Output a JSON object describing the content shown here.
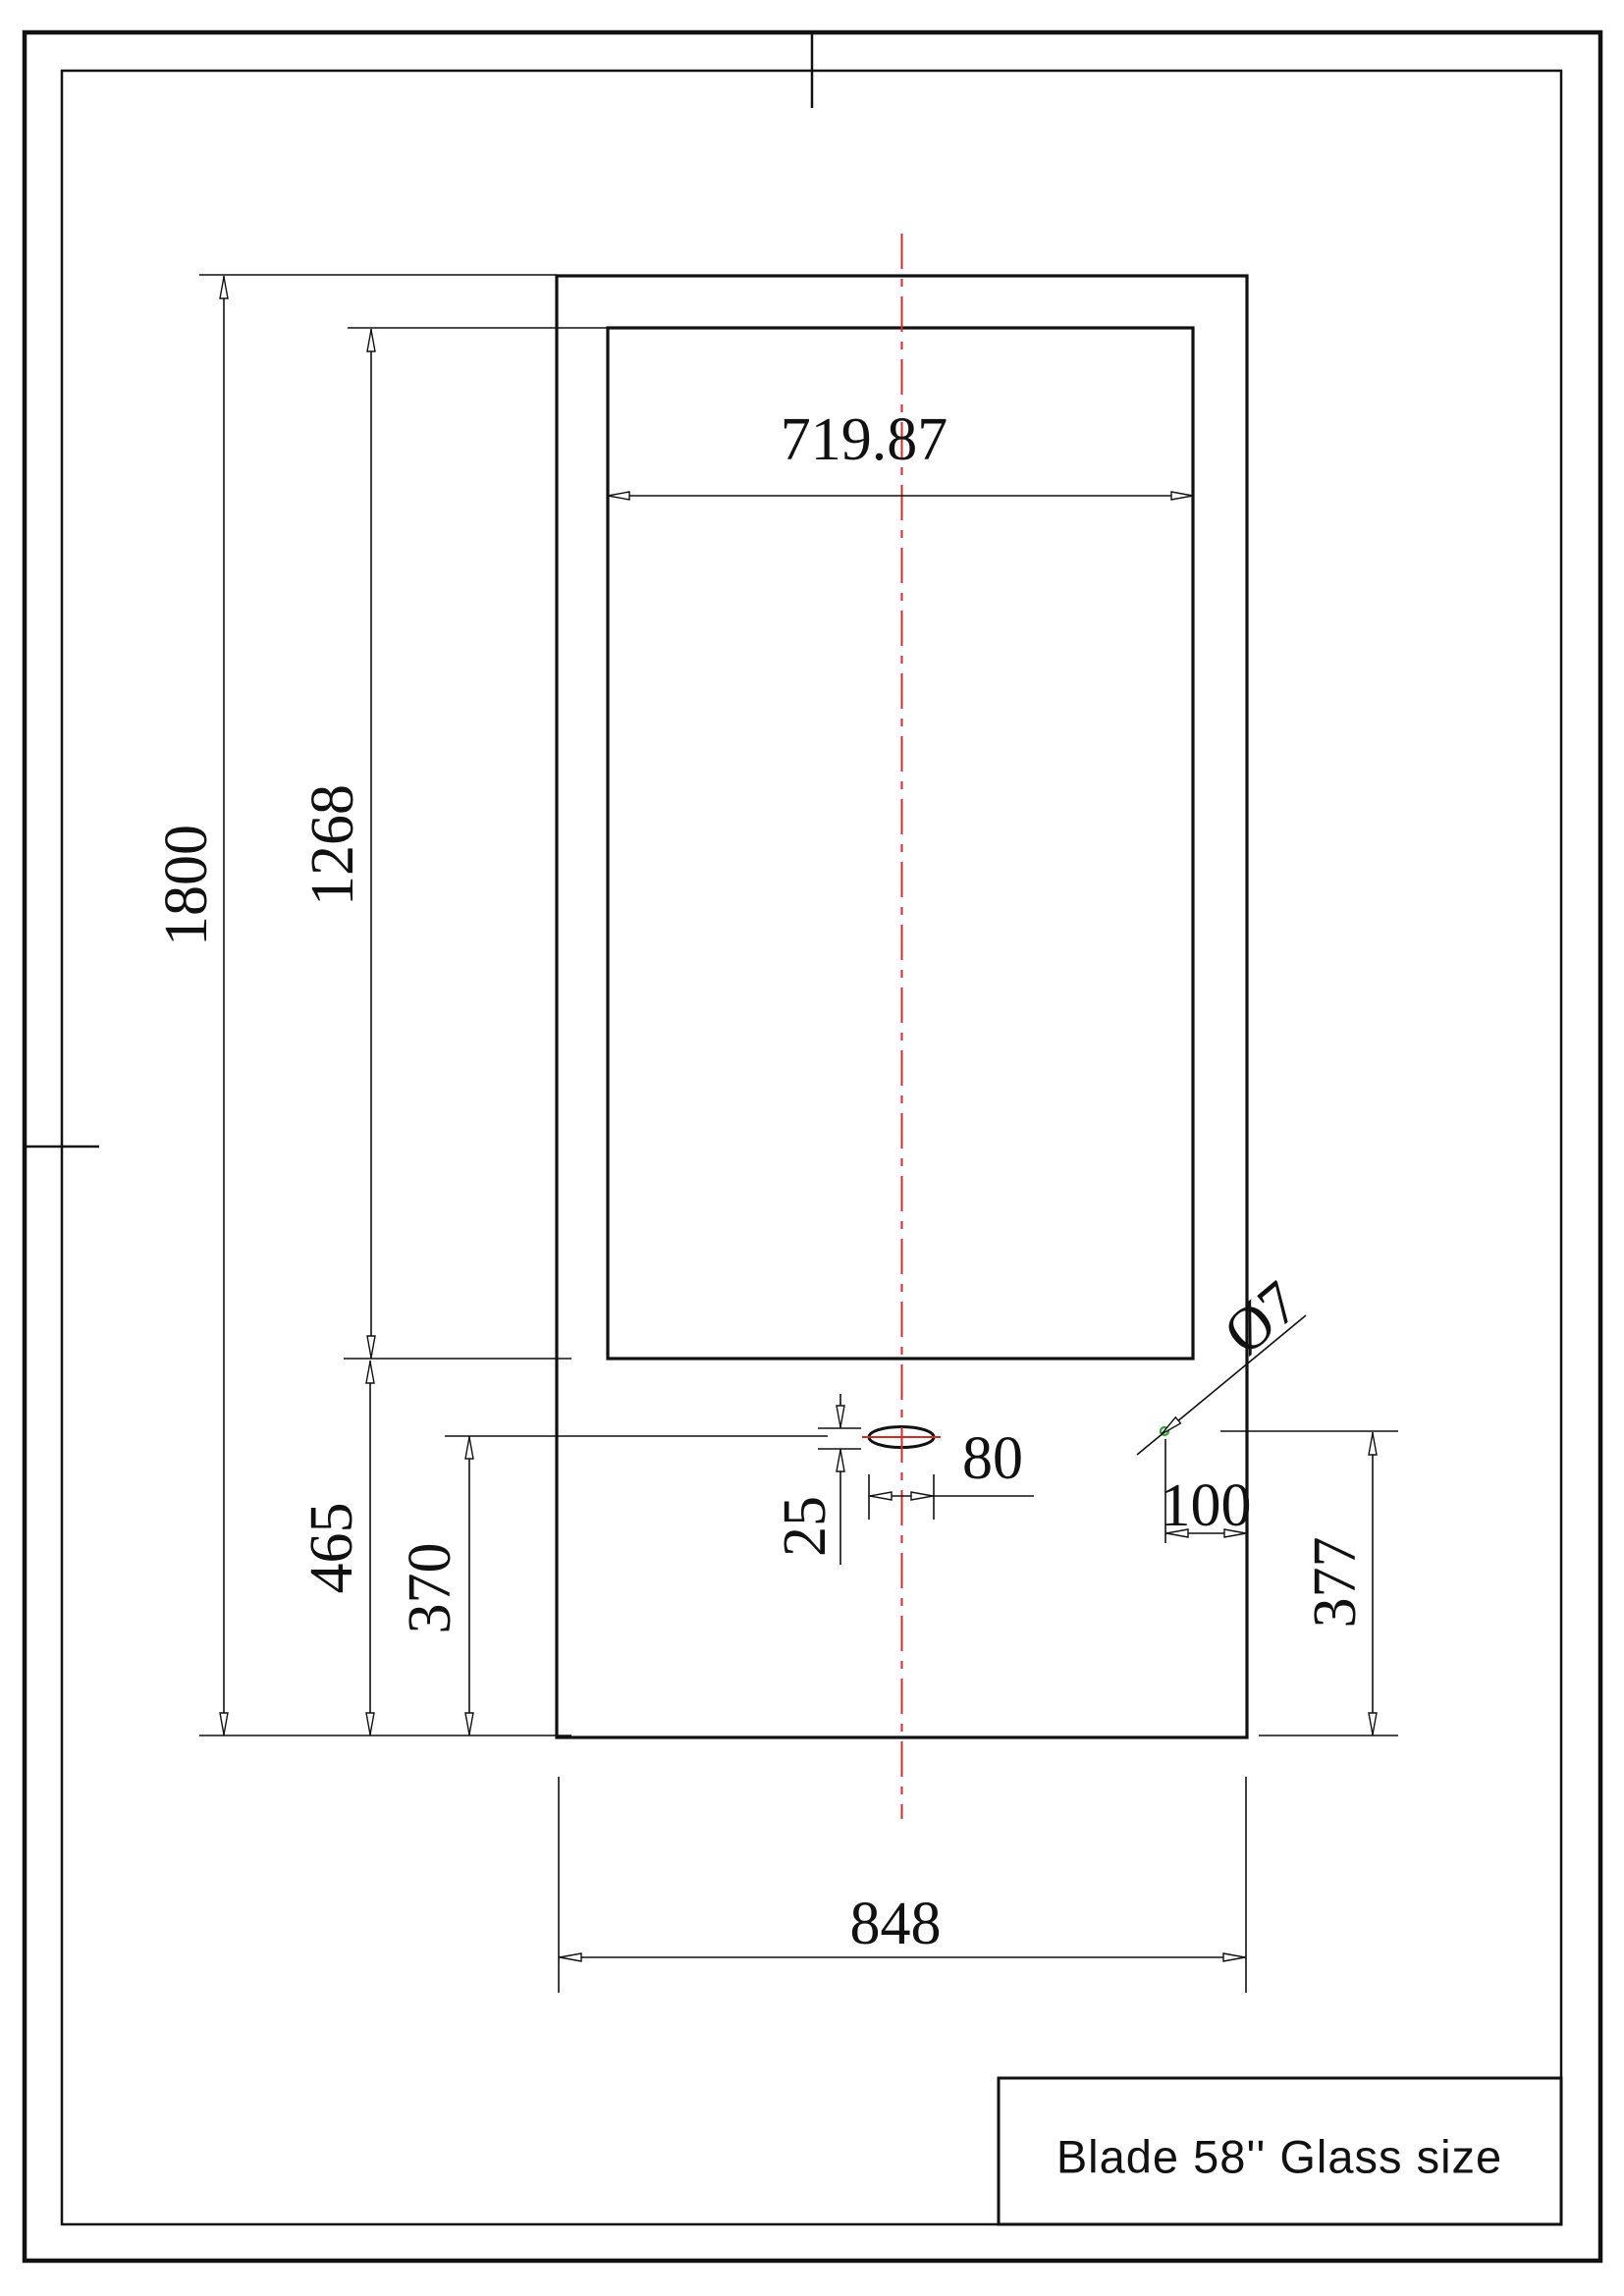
{
  "drawing": {
    "title_block": {
      "title": "Blade 58'' Glass size"
    },
    "dims": {
      "d719": {
        "label": "719.87"
      },
      "d1800": {
        "label": "1800"
      },
      "d1268": {
        "label": "1268"
      },
      "d465": {
        "label": "465"
      },
      "d370": {
        "label": "370"
      },
      "d25": {
        "label": "25"
      },
      "d80": {
        "label": "80"
      },
      "d100": {
        "label": "100"
      },
      "d377": {
        "label": "377"
      },
      "d848": {
        "label": "848"
      },
      "dia7": {
        "label": "Ø7"
      }
    },
    "colors": {
      "line_black": "#111111",
      "centerline_red": "#d42a2a",
      "hole_green": "#2fa12f",
      "paper_white": "#ffffff"
    }
  }
}
